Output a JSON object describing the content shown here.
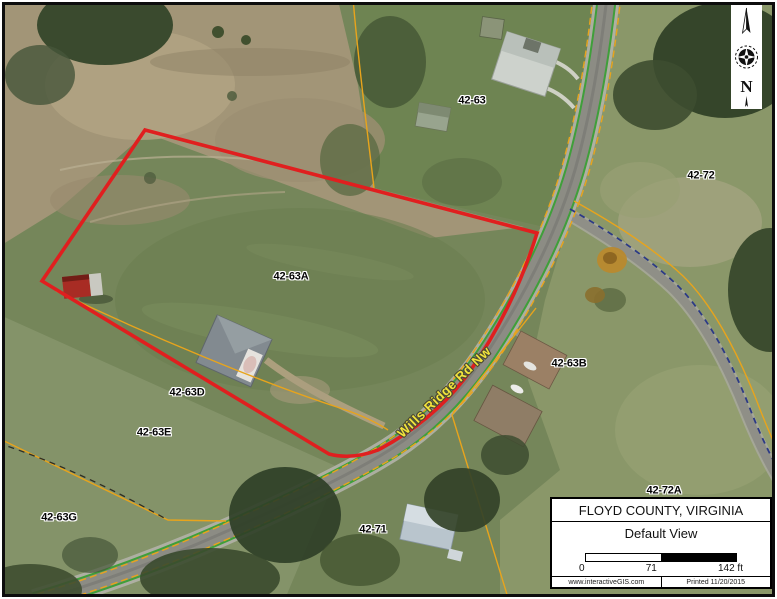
{
  "legend": {
    "region_title": "FLOYD COUNTY, VIRGINIA",
    "view_name": "Default View",
    "scale": {
      "start": "0",
      "mid": "71",
      "end": "142 ft"
    },
    "website": "www.interactiveGIS.com",
    "printed": "Printed 11/20/2015"
  },
  "north": {
    "label": "N"
  },
  "map": {
    "road_label": "Wills Ridge Rd Nw",
    "parcels": [
      {
        "label": "42-63"
      },
      {
        "label": "42-72"
      },
      {
        "label": "42-63A"
      },
      {
        "label": "42-63B"
      },
      {
        "label": "42-63D"
      },
      {
        "label": "42-63E"
      },
      {
        "label": "42-63G"
      },
      {
        "label": "42-72A"
      },
      {
        "label": "42-71"
      }
    ],
    "colors": {
      "selected_parcel_boundary": "#e01f1f",
      "parcel_line": "#e8a41c",
      "road_edge_line": "#3f9f3a",
      "hydro_dashed_line": "#2c3a85",
      "road_label_text": "#f2e43c"
    }
  }
}
